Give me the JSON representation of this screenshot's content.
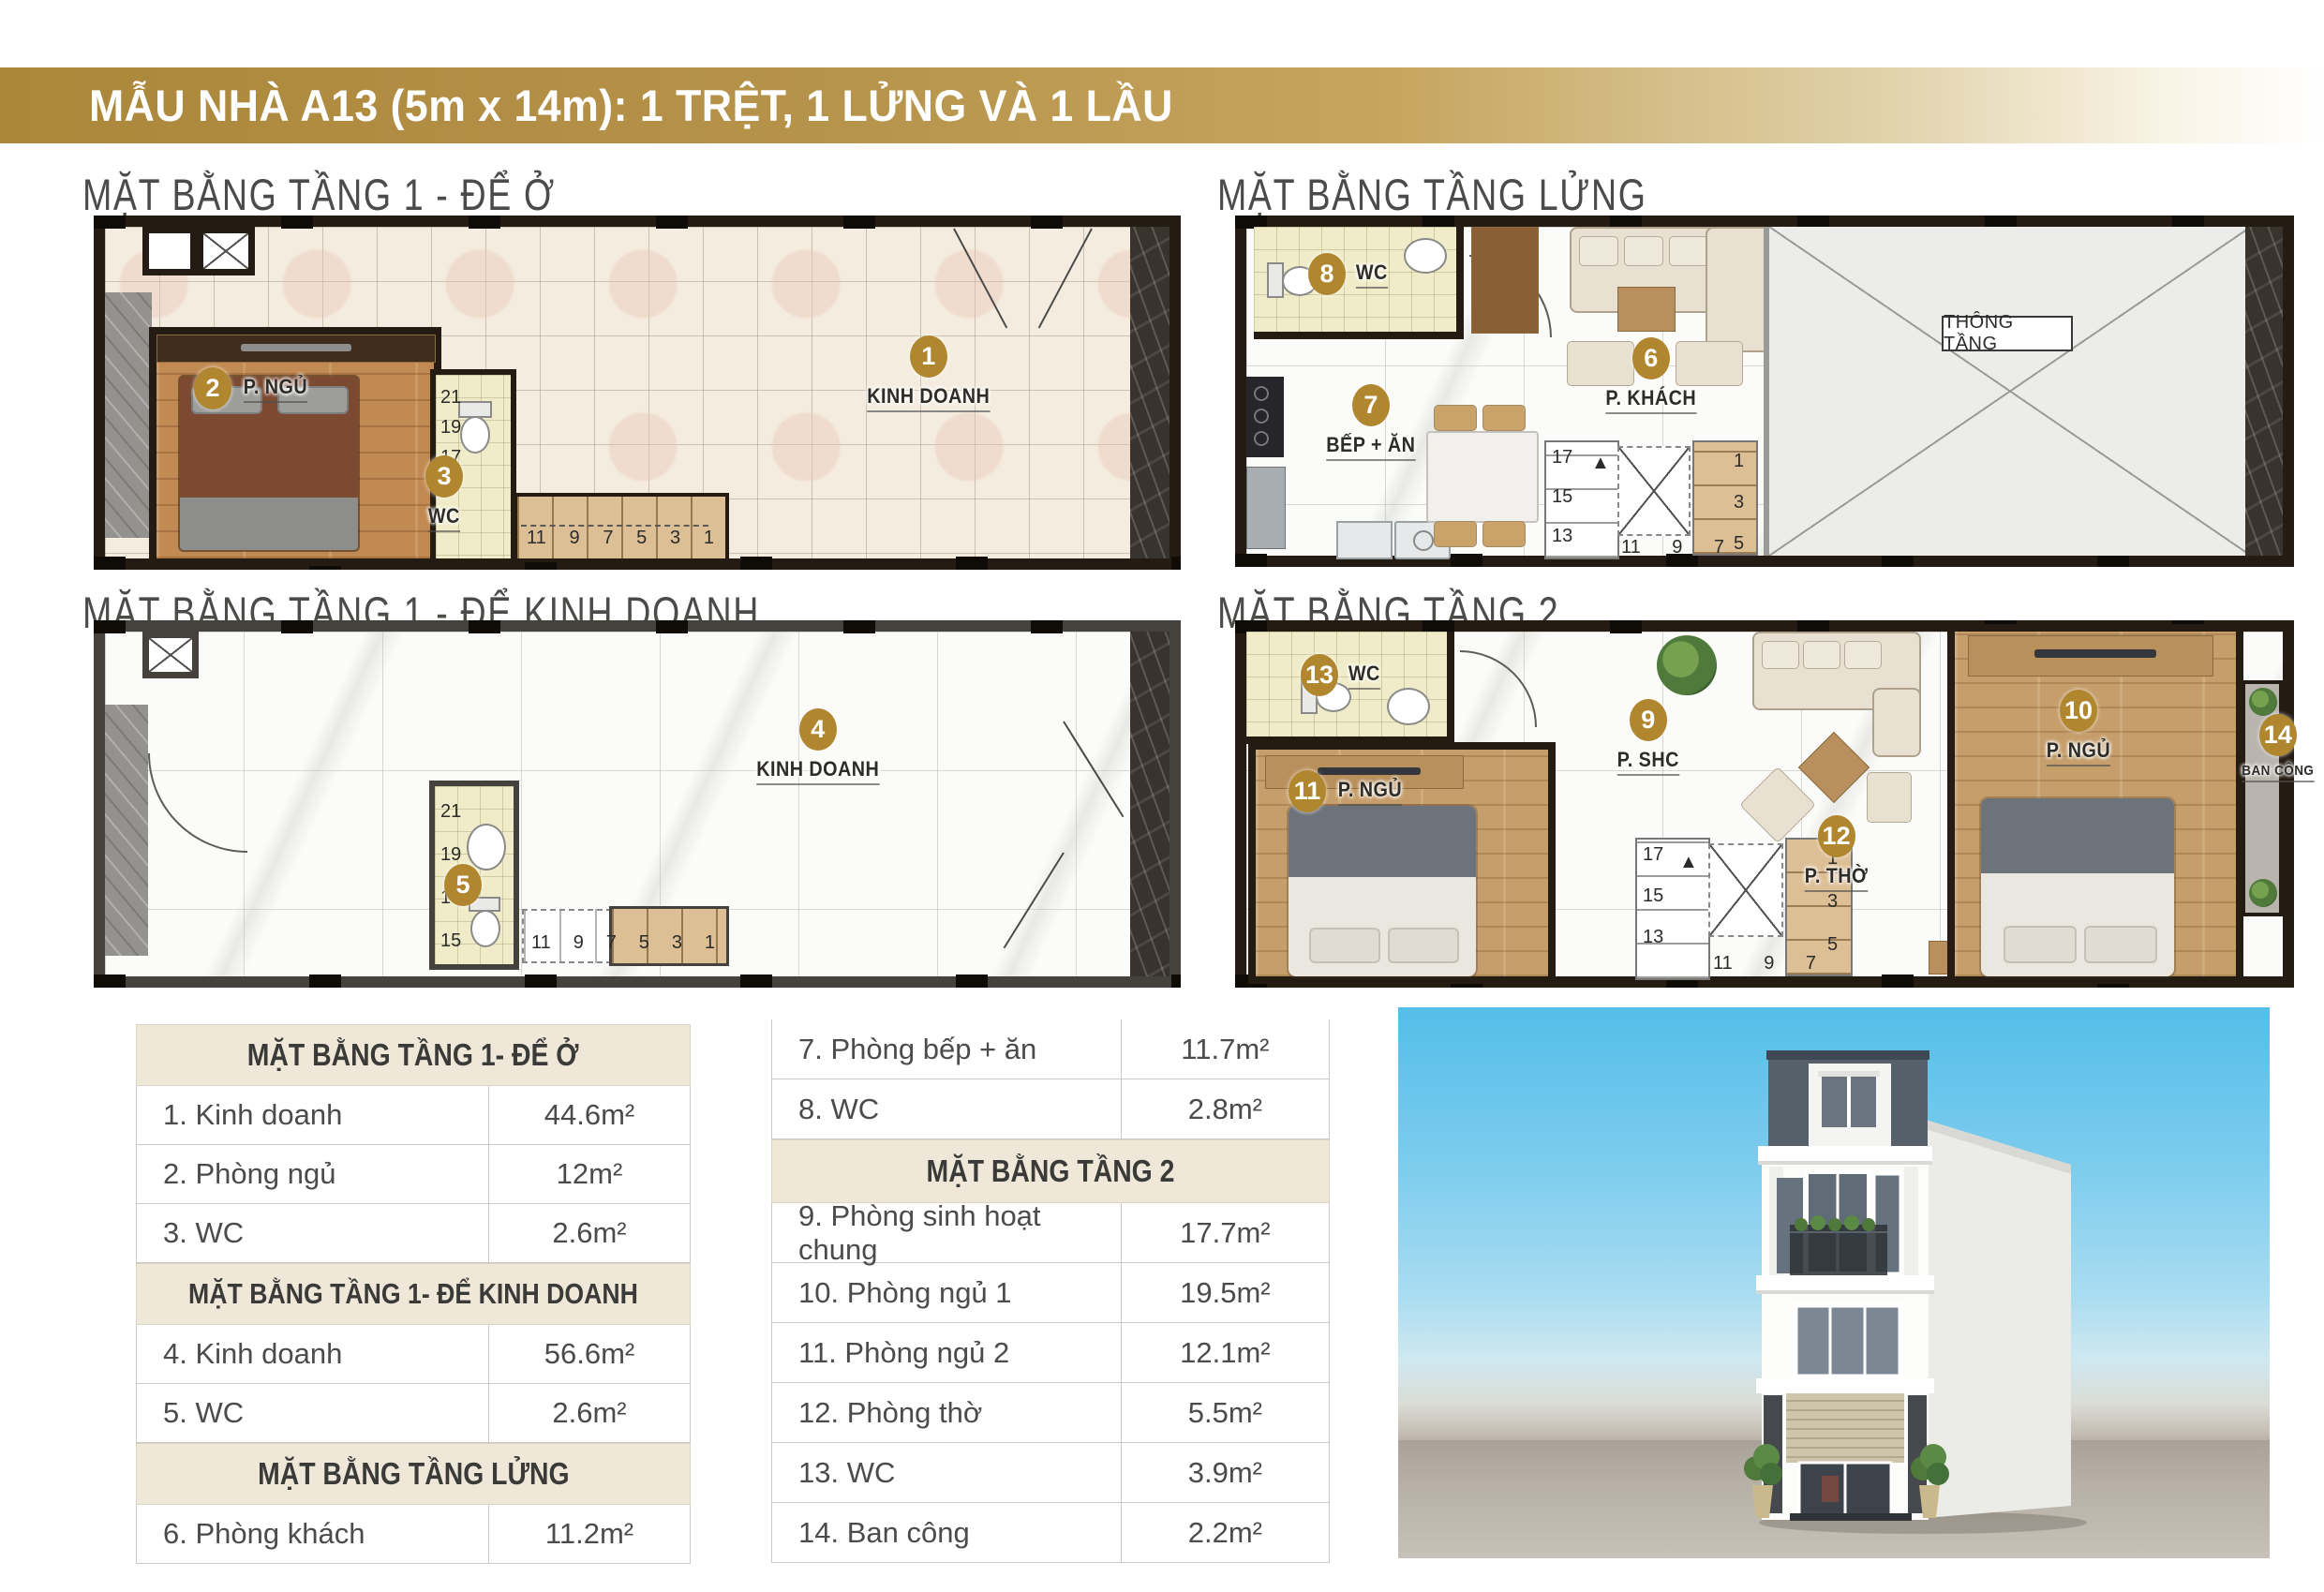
{
  "banner": {
    "title": "MẪU NHÀ A13 (5m x 14m): 1 TRỆT, 1 LỬNG VÀ 1 LẦU"
  },
  "plans": {
    "floor1_live": {
      "title": "MẶT BẰNG TẦNG 1 - ĐỂ Ở",
      "labels": {
        "business": {
          "num": "1",
          "text": "KINH DOANH"
        },
        "bedroom": {
          "num": "2",
          "text": "P. NGỦ"
        },
        "wc": {
          "num": "3",
          "text": "WC"
        }
      },
      "stair_numbers_vertical": [
        "21",
        "19",
        "17"
      ],
      "stair_numbers_bottom": [
        "11",
        "9",
        "7",
        "5",
        "3",
        "1"
      ]
    },
    "mezzanine": {
      "title": "MẶT BẰNG TẦNG LỬNG",
      "labels": {
        "wc": {
          "num": "8",
          "text": "WC"
        },
        "kitchen": {
          "num": "7",
          "text": "BẾP + ĂN"
        },
        "living": {
          "num": "6",
          "text": "P. KHÁCH"
        }
      },
      "void_label": "THÔNG TẦNG",
      "stair_numbers_left": [
        "17",
        "15",
        "13"
      ],
      "stair_numbers_right": [
        "1",
        "3",
        "5"
      ],
      "stair_numbers_bottom": [
        "11",
        "9",
        "7"
      ]
    },
    "floor1_business": {
      "title": "MẶT BẰNG TẦNG 1 - ĐỂ KINH DOANH",
      "labels": {
        "business": {
          "num": "4",
          "text": "KINH DOANH"
        },
        "wc": {
          "num": "5",
          "text": ""
        }
      },
      "stair_numbers_vertical": [
        "21",
        "19",
        "17",
        "15"
      ],
      "stair_numbers_bottom": [
        "11",
        "9",
        "7",
        "5",
        "3",
        "1"
      ]
    },
    "floor2": {
      "title": "MẶT BẰNG TẦNG 2",
      "labels": {
        "wc": {
          "num": "13",
          "text": "WC"
        },
        "common": {
          "num": "9",
          "text": "P. SHC"
        },
        "bedroom2": {
          "num": "11",
          "text": "P. NGỦ"
        },
        "worship": {
          "num": "12",
          "text": "P. THỜ"
        },
        "bedroom1": {
          "num": "10",
          "text": "P. NGỦ"
        },
        "balcony": {
          "num": "14",
          "text": "BAN CÔNG"
        }
      },
      "stair_numbers_left": [
        "17",
        "15",
        "13"
      ],
      "stair_numbers_right": [
        "1",
        "3",
        "5"
      ],
      "stair_numbers_bottom": [
        "11",
        "9",
        "7"
      ]
    }
  },
  "icons": {
    "stair_arrow": "▲"
  },
  "tables": {
    "left": {
      "sections": [
        {
          "header": "MẶT BẰNG TẦNG 1- ĐỂ Ở",
          "rows": [
            {
              "label": "1. Kinh doanh",
              "area": "44.6m²"
            },
            {
              "label": "2. Phòng ngủ",
              "area": "12m²"
            },
            {
              "label": "3. WC",
              "area": "2.6m²"
            }
          ]
        },
        {
          "header": "MẶT BẰNG TẦNG 1- ĐỂ KINH DOANH",
          "rows": [
            {
              "label": "4. Kinh doanh",
              "area": "56.6m²"
            },
            {
              "label": "5. WC",
              "area": "2.6m²"
            }
          ]
        },
        {
          "header": "MẶT BẰNG TẦNG LỬNG",
          "rows": [
            {
              "label": "6. Phòng khách",
              "area": "11.2m²"
            }
          ]
        }
      ]
    },
    "right": {
      "rows_top": [
        {
          "label": "7. Phòng bếp + ăn",
          "area": "11.7m²"
        },
        {
          "label": "8. WC",
          "area": "2.8m²"
        }
      ],
      "header": "MẶT BẰNG TẦNG 2",
      "rows_bottom": [
        {
          "label": "9. Phòng sinh hoạt chung",
          "area": "17.7m²"
        },
        {
          "label": "10. Phòng ngủ 1",
          "area": "19.5m²"
        },
        {
          "label": "11. Phòng ngủ 2",
          "area": "12.1m²"
        },
        {
          "label": "12. Phòng thờ",
          "area": "5.5m²"
        },
        {
          "label": "13. WC",
          "area": "3.9m²"
        },
        {
          "label": "14. Ban công",
          "area": "2.2m²"
        }
      ]
    }
  },
  "colors": {
    "gold": "#b0862e",
    "banner_gold": "#ab873a",
    "table_header_bg": "#efe8d8"
  }
}
